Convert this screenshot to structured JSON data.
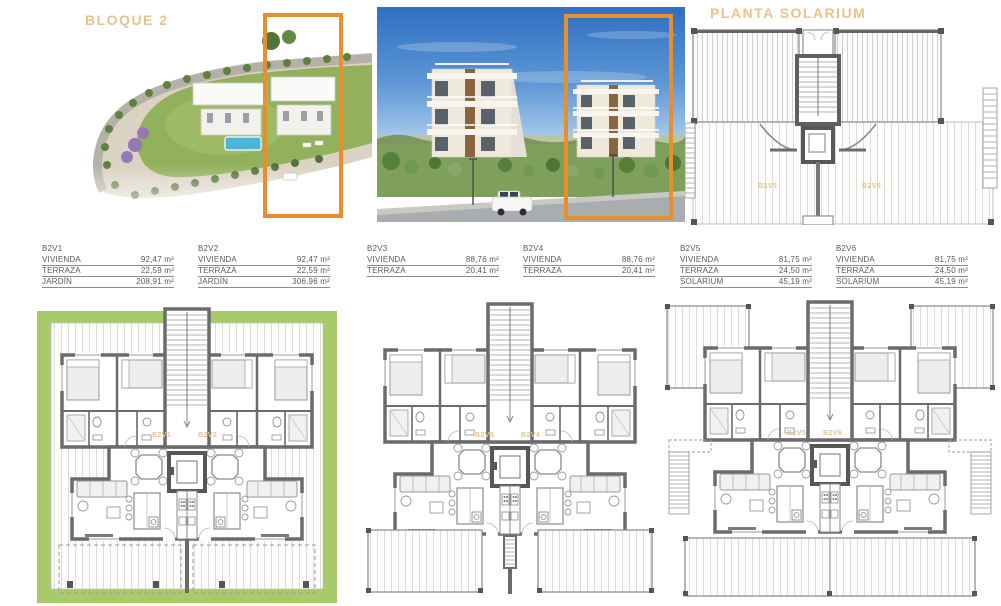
{
  "page": {
    "title_left": "BLOQUE 2",
    "title_right": "PLANTA SOLARIUM"
  },
  "colors": {
    "accent_orange": "#e78e2d",
    "label_tan": "#e9c28c",
    "garden_green": "#a9ca6b",
    "wall_grey": "#6b6b6b"
  },
  "units": [
    {
      "id": "B2V1",
      "rows": [
        {
          "label": "VIVIENDA",
          "value": "92,47 m²"
        },
        {
          "label": "TERRAZA",
          "value": "22,59 m²"
        },
        {
          "label": "JARDÍN",
          "value": "208,91 m²"
        }
      ]
    },
    {
      "id": "B2V2",
      "rows": [
        {
          "label": "VIVIENDA",
          "value": "92,47 m²"
        },
        {
          "label": "TERRAZA",
          "value": "22,59 m²"
        },
        {
          "label": "JARDÍN",
          "value": "306,96 m²"
        }
      ]
    },
    {
      "id": "B2V3",
      "rows": [
        {
          "label": "VIVIENDA",
          "value": "88,76 m²"
        },
        {
          "label": "TERRAZA",
          "value": "20,41 m²"
        }
      ]
    },
    {
      "id": "B2V4",
      "rows": [
        {
          "label": "VIVIENDA",
          "value": "88,76 m²"
        },
        {
          "label": "TERRAZA",
          "value": "20,41 m²"
        }
      ]
    },
    {
      "id": "B2V5",
      "rows": [
        {
          "label": "VIVIENDA",
          "value": "81,75 m²"
        },
        {
          "label": "TERRAZA",
          "value": "24,50 m²"
        },
        {
          "label": "SOLARIUM",
          "value": "45,19 m²"
        }
      ]
    },
    {
      "id": "B2V6",
      "rows": [
        {
          "label": "VIVIENDA",
          "value": "81,75 m²"
        },
        {
          "label": "TERRAZA",
          "value": "24,50 m²"
        },
        {
          "label": "SOLARIUM",
          "value": "45,19 m²"
        }
      ]
    }
  ],
  "plan_labels": {
    "ground": {
      "left": "B2V1",
      "right": "B2V2"
    },
    "first": {
      "left": "B2V3",
      "right": "B2V4"
    },
    "top": {
      "left": "B2V5",
      "right": "B2V6"
    },
    "solarium": {
      "left": "B2V5",
      "right": "B2V6"
    }
  }
}
